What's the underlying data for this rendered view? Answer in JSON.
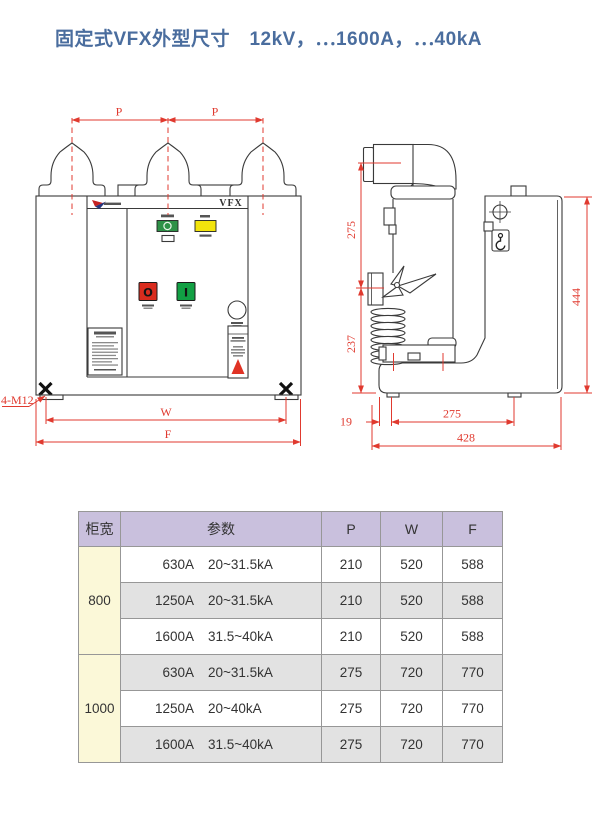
{
  "title": {
    "text": "固定式VFX外型尺寸　12kV，⋯1600A，⋯40kA",
    "color": "#4a6d9e"
  },
  "drawings": {
    "front_view": {
      "product_label": "VFX",
      "logo": "brand-logo",
      "buttons": {
        "open_symbol": "O",
        "close_symbol": "I"
      },
      "dimensions": {
        "pole_pitch_left": "P",
        "pole_pitch_right": "P",
        "mounting_width": "W",
        "front_width": "F",
        "mounting_bolts": "4-M12"
      }
    },
    "side_view": {
      "dimensions": {
        "upper_height": "275",
        "lower_height": "237",
        "rear_height": "444",
        "front_offset": "19",
        "mounting_depth": "275",
        "total_depth": "428"
      }
    }
  },
  "table": {
    "headers": {
      "cabinet_width": "柜宽",
      "parameters": "参数",
      "p": "P",
      "w": "W",
      "f": "F"
    },
    "groups": [
      {
        "cabinet_width": "800",
        "rows": [
          {
            "current": "630A",
            "breaking": "20~31.5kA",
            "p": "210",
            "w": "520",
            "f": "588"
          },
          {
            "current": "1250A",
            "breaking": "20~31.5kA",
            "p": "210",
            "w": "520",
            "f": "588"
          },
          {
            "current": "1600A",
            "breaking": "31.5~40kA",
            "p": "210",
            "w": "520",
            "f": "588"
          }
        ]
      },
      {
        "cabinet_width": "1000",
        "rows": [
          {
            "current": "630A",
            "breaking": "20~31.5kA",
            "p": "275",
            "w": "720",
            "f": "770"
          },
          {
            "current": "1250A",
            "breaking": "20~40kA",
            "p": "275",
            "w": "720",
            "f": "770"
          },
          {
            "current": "1600A",
            "breaking": "31.5~40kA",
            "p": "275",
            "w": "720",
            "f": "770"
          }
        ]
      }
    ]
  },
  "colors": {
    "title": "#4a6d9e",
    "dimension_red": "#e03a2f",
    "drawing_line": "#3a3a3a",
    "table_header_bg": "#c9c0dd",
    "cabinet_width_bg": "#fbf8d8",
    "row_alt_bg": "#e2e2e2",
    "indicator_green": "#2e9147",
    "indicator_yellow": "#f2e40c",
    "button_red": "#d92c1e",
    "button_green": "#12a044",
    "warning_red": "#e03325"
  }
}
